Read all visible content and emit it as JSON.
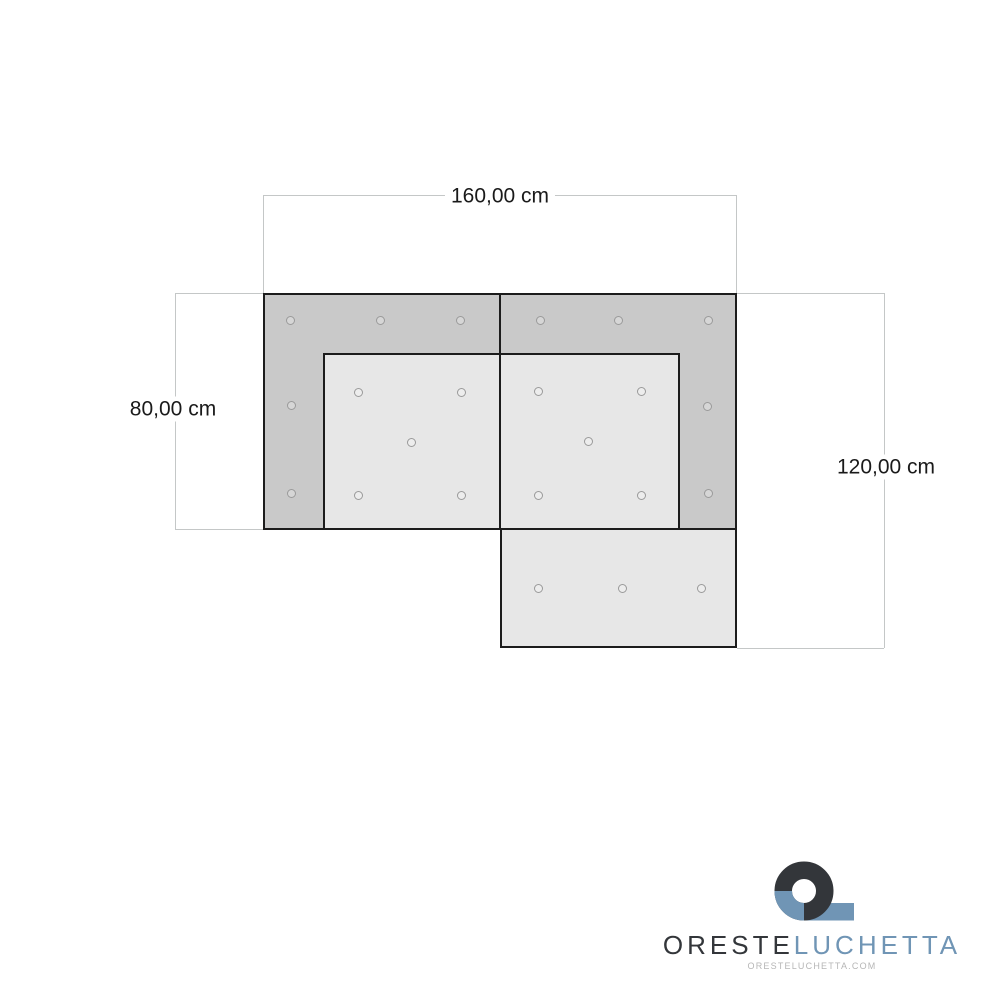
{
  "document": {
    "type": "furniture-dimension-drawing",
    "subject": "corner sofa top view with tufting buttons"
  },
  "dimensions": {
    "width_label": "160,00 cm",
    "depth_left_label": "80,00 cm",
    "depth_right_label": "120,00 cm"
  },
  "drawing": {
    "buttons": [
      {
        "x": 290,
        "y": 320
      },
      {
        "x": 380,
        "y": 320
      },
      {
        "x": 460,
        "y": 320
      },
      {
        "x": 540,
        "y": 320
      },
      {
        "x": 618,
        "y": 320
      },
      {
        "x": 708,
        "y": 320
      },
      {
        "x": 291,
        "y": 405
      },
      {
        "x": 291,
        "y": 493
      },
      {
        "x": 707,
        "y": 406
      },
      {
        "x": 708,
        "y": 493
      },
      {
        "x": 358,
        "y": 392
      },
      {
        "x": 461,
        "y": 392
      },
      {
        "x": 411,
        "y": 442
      },
      {
        "x": 358,
        "y": 495
      },
      {
        "x": 461,
        "y": 495
      },
      {
        "x": 538,
        "y": 391
      },
      {
        "x": 641,
        "y": 391
      },
      {
        "x": 588,
        "y": 441
      },
      {
        "x": 538,
        "y": 495
      },
      {
        "x": 641,
        "y": 495
      },
      {
        "x": 538,
        "y": 588
      },
      {
        "x": 622,
        "y": 588
      },
      {
        "x": 701,
        "y": 588
      }
    ]
  },
  "logo": {
    "name_primary": "ORESTE",
    "name_secondary": "LUCHETTA",
    "website": "ORESTELUCHETTA.COM",
    "icon": "q-mark-icon"
  },
  "colors": {
    "armrest_fill": "#c9c9c9",
    "cushion_fill": "#e7e7e7",
    "outline": "#1c1c1c",
    "dimension_line": "#c4c7c7",
    "button_ring": "#9a9a9a",
    "text": "#1a1a1a",
    "brand_dark": "#33363a",
    "brand_blue": "#7095b5",
    "brand_muted": "#b6b6b6"
  }
}
